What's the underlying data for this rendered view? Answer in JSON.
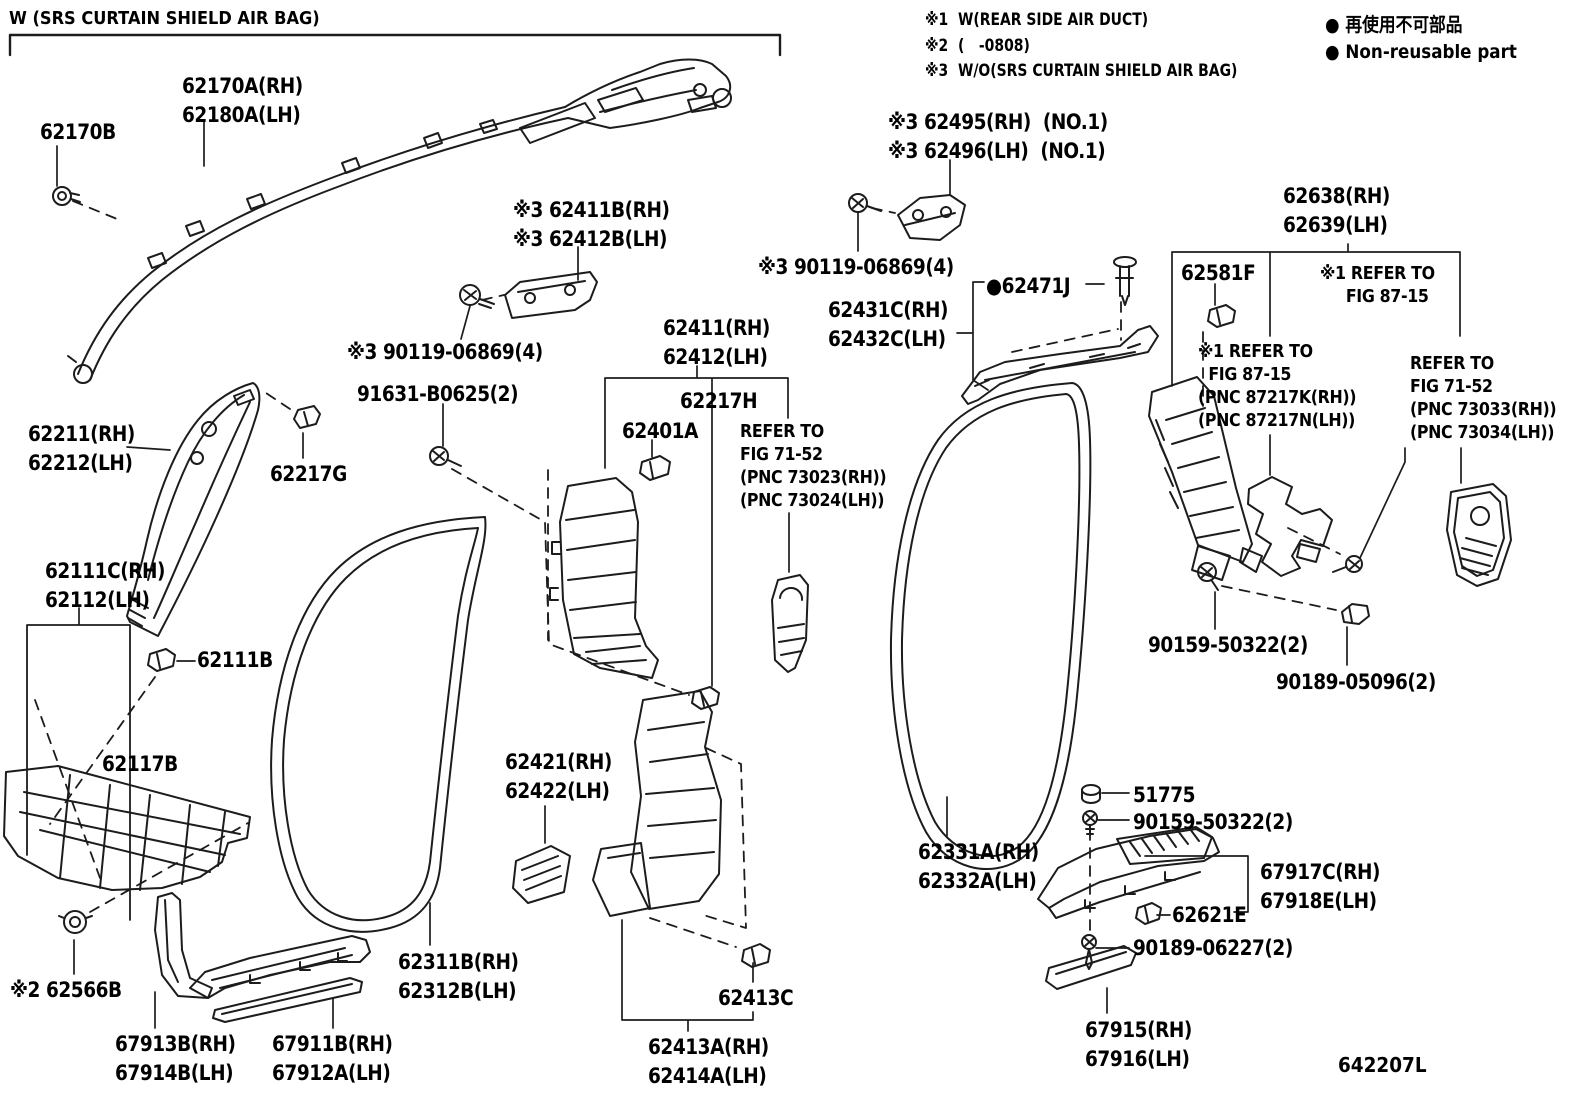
{
  "title": "W (SRS CURTAIN SHIELD AIR BAG)",
  "diagram_code": "642207L",
  "notes": [
    {
      "text": "※1  W(REAR SIDE AIR DUCT)"
    },
    {
      "text": "※2  (   -0808)"
    },
    {
      "text": "※3  W/O(SRS CURTAIN SHIELD AIR BAG)"
    }
  ],
  "legend": {
    "bullet": "●",
    "jp": "再使用不可部品",
    "en": "Non-reusable part"
  },
  "labels": [
    {
      "name": "62170a",
      "x": 182,
      "y": 72,
      "lines": [
        "62170A(RH)",
        "62180A(LH)"
      ]
    },
    {
      "name": "62170b",
      "x": 40,
      "y": 118,
      "lines": [
        "62170B"
      ]
    },
    {
      "name": "62411b",
      "x": 513,
      "y": 196,
      "lines": [
        "※3 62411B(RH)",
        "※3 62412B(LH)"
      ]
    },
    {
      "name": "62495",
      "x": 888,
      "y": 108,
      "lines": [
        "※3 62495(RH)  (NO.1)",
        "※3 62496(LH)  (NO.1)"
      ]
    },
    {
      "name": "90119-right",
      "x": 758,
      "y": 253,
      "lines": [
        "※3 90119-06869(4)"
      ]
    },
    {
      "name": "90119-left",
      "x": 347,
      "y": 338,
      "lines": [
        "※3 90119-06869(4)"
      ]
    },
    {
      "name": "91631",
      "x": 357,
      "y": 380,
      "lines": [
        "91631-B0625(2)"
      ]
    },
    {
      "name": "62411",
      "x": 663,
      "y": 314,
      "lines": [
        "62411(RH)",
        "62412(LH)"
      ]
    },
    {
      "name": "62217h",
      "x": 680,
      "y": 387,
      "lines": [
        "62217H"
      ]
    },
    {
      "name": "62401a",
      "x": 622,
      "y": 417,
      "lines": [
        "62401A"
      ]
    },
    {
      "name": "refer-7152-center",
      "x": 740,
      "y": 420,
      "size": "small",
      "lines": [
        "REFER TO",
        "FIG 71-52",
        "(PNC 73023(RH))",
        "(PNC 73024(LH))"
      ]
    },
    {
      "name": "62431c",
      "x": 828,
      "y": 296,
      "lines": [
        "62431C(RH)",
        "62432C(LH)"
      ]
    },
    {
      "name": "62471j",
      "x": 986,
      "y": 272,
      "lines": [
        "●62471J"
      ]
    },
    {
      "name": "62638",
      "x": 1283,
      "y": 182,
      "lines": [
        "62638(RH)",
        "62639(LH)"
      ]
    },
    {
      "name": "62581f",
      "x": 1181,
      "y": 259,
      "lines": [
        "62581F"
      ]
    },
    {
      "name": "refer-8715-right",
      "x": 1320,
      "y": 262,
      "size": "small",
      "lines": [
        "※1 REFER TO",
        "     FIG 87-15"
      ]
    },
    {
      "name": "refer-8715-left",
      "x": 1198,
      "y": 340,
      "size": "small",
      "lines": [
        "※1 REFER TO",
        "  FIG 87-15",
        "(PNC 87217K(RH))",
        "(PNC 87217N(LH))"
      ]
    },
    {
      "name": "refer-7152-right",
      "x": 1410,
      "y": 352,
      "size": "small",
      "lines": [
        "REFER TO",
        "FIG 71-52",
        "(PNC 73033(RH))",
        "(PNC 73034(LH))"
      ]
    },
    {
      "name": "62211",
      "x": 28,
      "y": 420,
      "lines": [
        "62211(RH)",
        "62212(LH)"
      ]
    },
    {
      "name": "62217g",
      "x": 270,
      "y": 460,
      "lines": [
        "62217G"
      ]
    },
    {
      "name": "62111c",
      "x": 45,
      "y": 557,
      "lines": [
        "62111C(RH)",
        "62112(LH)"
      ]
    },
    {
      "name": "62111b",
      "x": 197,
      "y": 646,
      "lines": [
        "62111B"
      ]
    },
    {
      "name": "62117b",
      "x": 102,
      "y": 750,
      "lines": [
        "62117B"
      ]
    },
    {
      "name": "62566b",
      "x": 10,
      "y": 976,
      "lines": [
        "※2 62566B"
      ]
    },
    {
      "name": "67913b",
      "x": 115,
      "y": 1030,
      "lines": [
        "67913B(RH)",
        "67914B(LH)"
      ]
    },
    {
      "name": "67911b",
      "x": 272,
      "y": 1030,
      "lines": [
        "67911B(RH)",
        "67912A(LH)"
      ]
    },
    {
      "name": "62311b",
      "x": 398,
      "y": 948,
      "lines": [
        "62311B(RH)",
        "62312B(LH)"
      ]
    },
    {
      "name": "62421",
      "x": 505,
      "y": 748,
      "lines": [
        "62421(RH)",
        "62422(LH)"
      ]
    },
    {
      "name": "62413c",
      "x": 718,
      "y": 984,
      "lines": [
        "62413C"
      ]
    },
    {
      "name": "62413a",
      "x": 648,
      "y": 1033,
      "lines": [
        "62413A(RH)",
        "62414A(LH)"
      ]
    },
    {
      "name": "62331a",
      "x": 918,
      "y": 838,
      "lines": [
        "62331A(RH)",
        "62332A(LH)"
      ]
    },
    {
      "name": "51775",
      "x": 1133,
      "y": 781,
      "lines": [
        "51775"
      ]
    },
    {
      "name": "90159-bottom",
      "x": 1133,
      "y": 808,
      "lines": [
        "90159-50322(2)"
      ]
    },
    {
      "name": "67917c",
      "x": 1260,
      "y": 858,
      "lines": [
        "67917C(RH)",
        "67918E(LH)"
      ]
    },
    {
      "name": "62621e",
      "x": 1172,
      "y": 901,
      "lines": [
        "62621E"
      ]
    },
    {
      "name": "90189-bottom",
      "x": 1133,
      "y": 934,
      "lines": [
        "90189-06227(2)"
      ]
    },
    {
      "name": "67915",
      "x": 1085,
      "y": 1016,
      "lines": [
        "67915(RH)",
        "67916(LH)"
      ]
    },
    {
      "name": "90159-mid",
      "x": 1148,
      "y": 631,
      "lines": [
        "90159-50322(2)"
      ]
    },
    {
      "name": "90189-mid",
      "x": 1276,
      "y": 668,
      "lines": [
        "90189-05096(2)"
      ]
    }
  ]
}
